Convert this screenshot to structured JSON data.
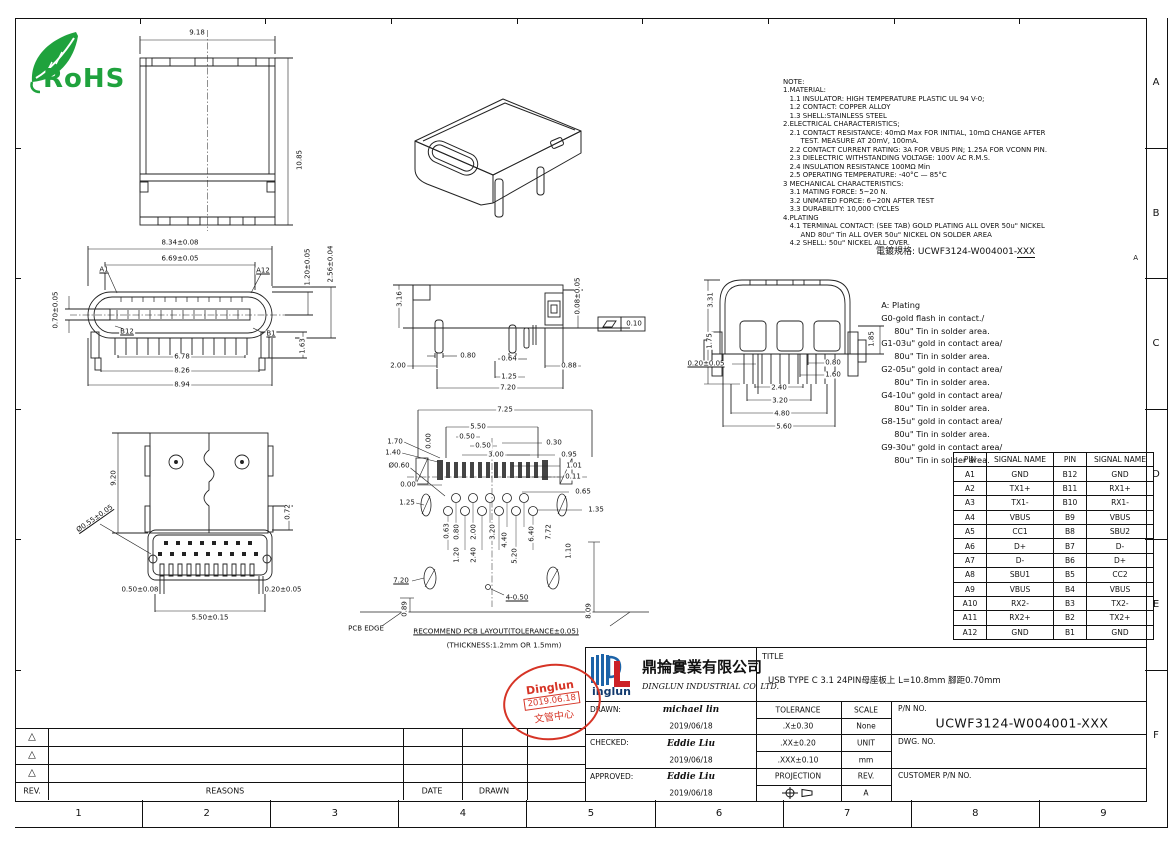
{
  "frame": {
    "row_labels": [
      "A",
      "B",
      "C",
      "D",
      "E",
      "F"
    ],
    "col_labels": [
      "1",
      "2",
      "3",
      "4",
      "5",
      "6",
      "7",
      "8",
      "9"
    ]
  },
  "rohs": {
    "label": "RoHS",
    "color": "#1fa23d"
  },
  "notes": {
    "lines": [
      "NOTE:",
      "1.MATERIAL:",
      "   1.1 INSULATOR: HIGH TEMPERATURE PLASTIC UL 94 V-0;",
      "   1.2 CONTACT: COPPER ALLOY",
      "   1.3 SHELL:STAINLESS STEEL",
      "2.ELECTRICAL CHARACTERISTICS;",
      "   2.1 CONTACT RESISTANCE: 40mΩ Max FOR INITIAL, 10mΩ CHANGE AFTER",
      "        TEST. MEASURE AT 20mV, 100mA.",
      "   2.2 CONTACT CURRENT RATING: 3A FOR VBUS PIN; 1.25A FOR VCONN PIN.",
      "   2.3 DIELECTRIC WITHSTANDING VOLTAGE: 100V AC R.M.S.",
      "   2.4 INSULATION RESISTANCE 100MΩ Min",
      "   2.5 OPERATING TEMPERATURE: -40°C — 85°C",
      "3 MECHANICAL CHARACTERISTICS:",
      "   3.1 MATING FORCE: 5~20 N.",
      "   3.2 UNMATED FORCE: 6~20N AFTER TEST",
      "   3.3 DURABILITY: 10,000 CYCLES",
      "4.PLATING",
      "   4.1 TERMINAL CONTACT: (SEE TAB) GOLD PLATING ALL OVER 50u\" NICKEL",
      "        AND 80u\" Tin ALL OVER 50u\" NICKEL ON SOLDER AREA",
      "   4.2 SHELL: 50u\" NICKEL ALL OVER."
    ]
  },
  "plating": {
    "header_label": "電鍍規格:",
    "pn_prefix": "UCWF3124-W004001-",
    "pn_suffix": "XXX",
    "rev_mark": "A",
    "lines": [
      "  A: Plating",
      "  G0-gold flash in contact./",
      "       80u\" Tin in solder area.",
      "  G1-03u\" gold in contact area/",
      "       80u\" Tin in solder area.",
      "  G2-05u\" gold in contact area/",
      "       80u\" Tin in solder area.",
      "  G4-10u\" gold in contact area/",
      "       80u\" Tin in solder area.",
      "  G8-15u\" gold in contact area/",
      "       80u\" Tin in solder area.",
      "  G9-30u\" gold in contact area/",
      "       80u\" Tin in solder area."
    ]
  },
  "pin_table": {
    "headers": [
      "PIN",
      "SIGNAL NAME",
      "PIN",
      "SIGNAL NAME"
    ],
    "rows": [
      [
        "A1",
        "GND",
        "B12",
        "GND"
      ],
      [
        "A2",
        "TX1+",
        "B11",
        "RX1+"
      ],
      [
        "A3",
        "TX1-",
        "B10",
        "RX1-"
      ],
      [
        "A4",
        "VBUS",
        "B9",
        "VBUS"
      ],
      [
        "A5",
        "CC1",
        "B8",
        "SBU2"
      ],
      [
        "A6",
        "D+",
        "B7",
        "D-"
      ],
      [
        "A7",
        "D-",
        "B6",
        "D+"
      ],
      [
        "A8",
        "SBU1",
        "B5",
        "CC2"
      ],
      [
        "A9",
        "VBUS",
        "B4",
        "VBUS"
      ],
      [
        "A10",
        "RX2-",
        "B3",
        "TX2-"
      ],
      [
        "A11",
        "RX2+",
        "B2",
        "TX2+"
      ],
      [
        "A12",
        "GND",
        "B1",
        "GND"
      ]
    ]
  },
  "views": {
    "top": {
      "w": "9.18",
      "h": "10.85"
    },
    "front": {
      "w_shell": "8.34±0.08",
      "w_tongue": "6.69±0.05",
      "pin_a1": "A1",
      "pin_a12": "A12",
      "pin_b12": "B12",
      "pin_b1": "B1",
      "h_tongue": "0.70±0.05",
      "h1": "1.20±0.05",
      "h2": "2.56±0.04",
      "leg": "1.63",
      "span1": "6.78",
      "span2": "8.26",
      "span3": "8.94"
    },
    "side": {
      "h_body": "3.16",
      "d1": "2.00",
      "d2": "0.80",
      "d3": "0.64",
      "d4": "0.88",
      "d5": "1.25",
      "d6": "7.20",
      "h_stand": "0.08±0.05",
      "flat": "0.10"
    },
    "rear": {
      "h1": "3.31",
      "h2": "1.75",
      "d1": "0.20±0.05",
      "h3": "1.85",
      "p1": "0.80",
      "p2": "1.60",
      "p3": "2.40",
      "p4": "3.20",
      "p5": "4.80",
      "p6": "5.60"
    },
    "bottom": {
      "h": "9.20",
      "d1": "0.72",
      "hole": "Ø0.55±0.05",
      "d2": "0.50±0.08",
      "d3": "0.20±0.05",
      "d4": "5.50±0.15"
    },
    "pcb": {
      "d1": "7.25",
      "d2": "5.50",
      "d3": "0.50",
      "d4": "0.50",
      "d5": "3.00",
      "d6": "0.30",
      "d7": "0.95",
      "d8": "1.01",
      "d9": "0.11",
      "d10": "0.65",
      "d11": "1.35",
      "d12": "1.70",
      "d13": "1.40",
      "d14": "Ø0.60",
      "d15": "0.00",
      "d16": "0.00",
      "d17": "1.25",
      "d18": "0.63",
      "d19": "0.80",
      "d20": "2.00",
      "d21": "3.20",
      "d22": "4.40",
      "d23": "5.20",
      "d24": "6.40",
      "d25": "7.72",
      "d26": "1.20",
      "d27": "2.40",
      "d28": "1.10",
      "d29": "7.20",
      "d30": "4-0.50",
      "d31": "0.89",
      "d32": "8.09",
      "edge": "PCB EDGE",
      "note1": "RECOMMEND PCB LAYOUT(TOLERANCE±0.05)",
      "note2": "(THICKNESS:1.2mm OR 1.5mm)"
    }
  },
  "stamp": {
    "line1": "Dinglun",
    "line2": "2019.06.18",
    "line3": "文管中心",
    "color": "#d63426"
  },
  "title_block": {
    "company_cn": "鼎掄實業有限公司",
    "company_en": "DINGLUN INDUSTRIAL CO. LTD.",
    "logo_text": "inglun",
    "title_label": "TITLE",
    "title": "USB TYPE C 3.1 24PIN母座板上 L=10.8mm 腳距0.70mm",
    "drawn_label": "DRAWN:",
    "drawn_name": "michael lin",
    "drawn_date": "2019/06/18",
    "checked_label": "CHECKED:",
    "checked_name": "Eddie Liu",
    "checked_date": "2019/06/18",
    "approved_label": "APPROVED:",
    "approved_name": "Eddie Liu",
    "approved_date": "2019/06/18",
    "tolerance_label": "TOLERANCE",
    "tol_x": ".X±0.30",
    "tol_xx": ".XX±0.20",
    "tol_xxx": ".XXX±0.10",
    "scale_label": "SCALE",
    "scale_value": "None",
    "unit_label": "UNIT",
    "unit_value": "mm",
    "projection_label": "PROJECTION",
    "rev_label": "REV.",
    "rev_value": "A",
    "pn_label": "P/N NO.",
    "pn_value": "UCWF3124-W004001-XXX",
    "dwg_label": "DWG. NO.",
    "customer_label": "CUSTOMER P/N NO."
  },
  "revision": {
    "rev_label": "REV.",
    "reasons_label": "REASONS",
    "date_label": "DATE",
    "drawn_label": "DRAWN",
    "marks": [
      "△",
      "△",
      "△"
    ]
  }
}
